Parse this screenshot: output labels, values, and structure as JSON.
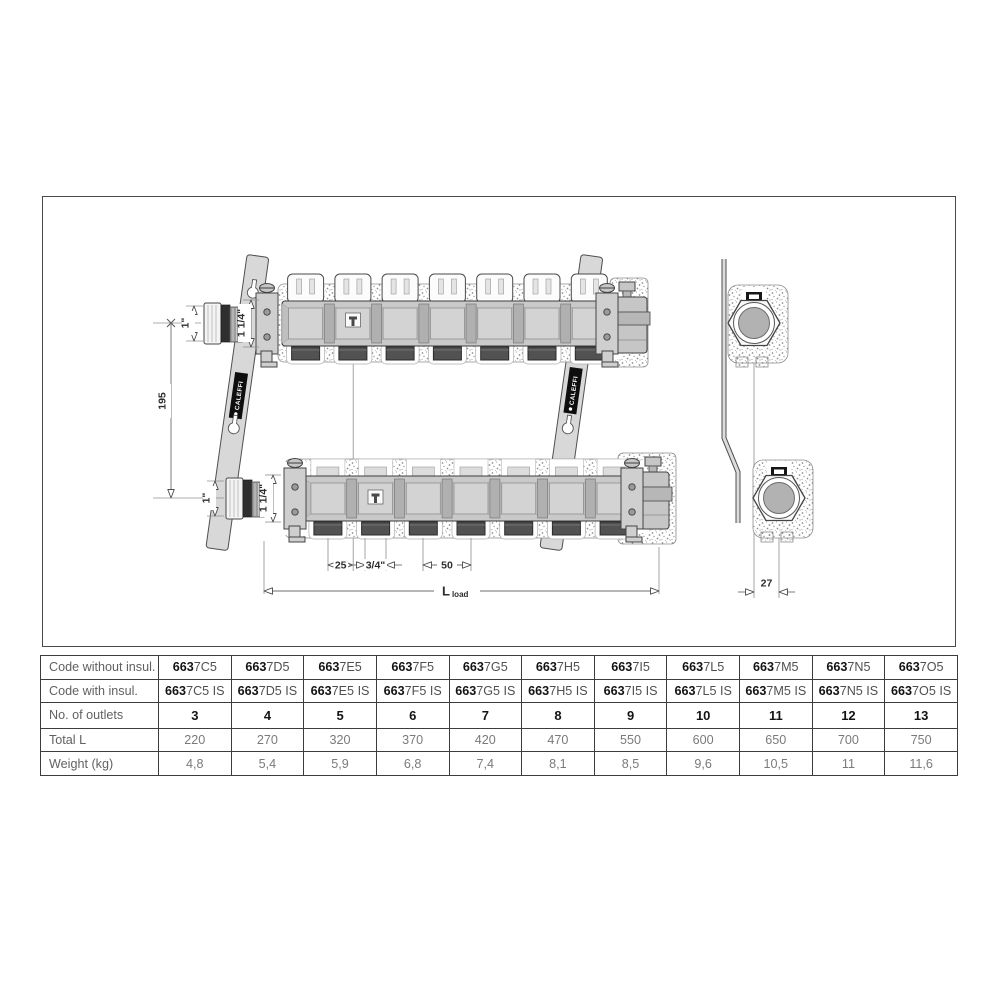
{
  "drawing": {
    "brand": "CALEFFI",
    "dims": {
      "cap_thread": "1\"",
      "main_thread": "1 1/4\"",
      "centre_distance": "195",
      "outlet_offset": "25",
      "outlet_connection": "3/4\"",
      "outlet_spacing": "50",
      "length_symbol": "L",
      "length_subscript": "load",
      "depth_offset": "27"
    }
  },
  "table": {
    "row_labels": [
      "Code without insul.",
      "Code with insul.",
      "No. of outlets",
      "Total L",
      "Weight (kg)"
    ],
    "code_prefix": "663",
    "columns": [
      {
        "code": "7C5",
        "code_is": "7C5 IS",
        "outlets": "3",
        "total_l": "220",
        "weight": "4,8"
      },
      {
        "code": "7D5",
        "code_is": "7D5 IS",
        "outlets": "4",
        "total_l": "270",
        "weight": "5,4"
      },
      {
        "code": "7E5",
        "code_is": "7E5 IS",
        "outlets": "5",
        "total_l": "320",
        "weight": "5,9"
      },
      {
        "code": "7F5",
        "code_is": "7F5 IS",
        "outlets": "6",
        "total_l": "370",
        "weight": "6,8"
      },
      {
        "code": "7G5",
        "code_is": "7G5 IS",
        "outlets": "7",
        "total_l": "420",
        "weight": "7,4"
      },
      {
        "code": "7H5",
        "code_is": "7H5 IS",
        "outlets": "8",
        "total_l": "470",
        "weight": "8,1"
      },
      {
        "code": "7I5",
        "code_is": "7I5 IS",
        "outlets": "9",
        "total_l": "550",
        "weight": "8,5"
      },
      {
        "code": "7L5",
        "code_is": "7L5 IS",
        "outlets": "10",
        "total_l": "600",
        "weight": "9,6"
      },
      {
        "code": "7M5",
        "code_is": "7M5 IS",
        "outlets": "11",
        "total_l": "650",
        "weight": "10,5"
      },
      {
        "code": "7N5",
        "code_is": "7N5 IS",
        "outlets": "12",
        "total_l": "700",
        "weight": "11"
      },
      {
        "code": "7O5",
        "code_is": "7O5 IS",
        "outlets": "13",
        "total_l": "750",
        "weight": "11,6"
      }
    ]
  }
}
